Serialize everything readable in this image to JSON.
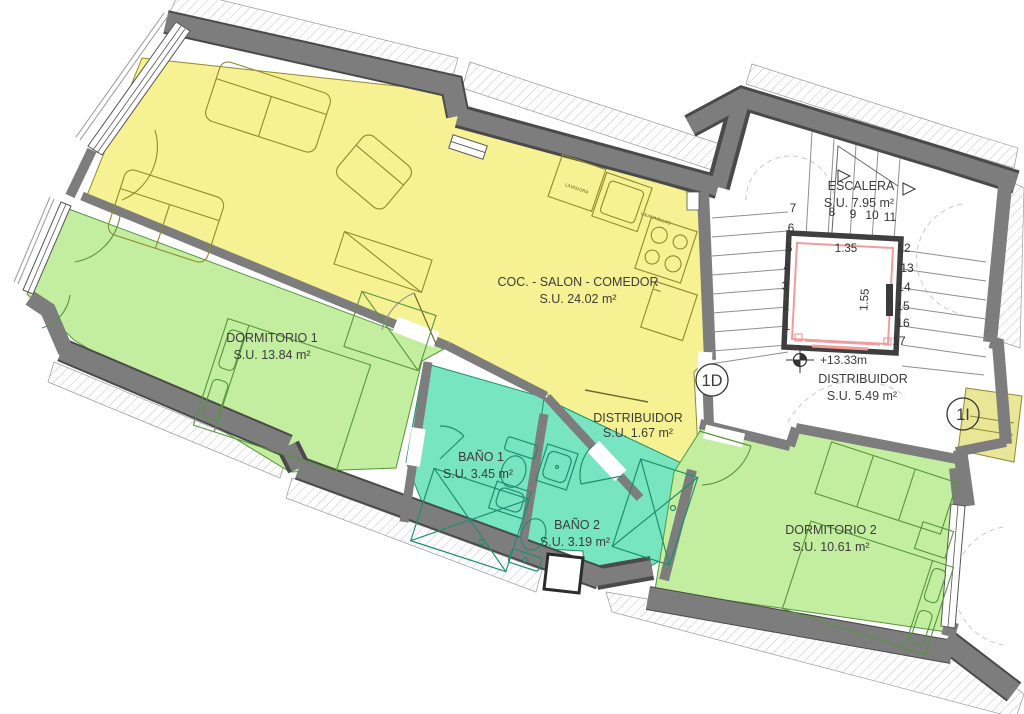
{
  "plan": {
    "type": "architectural-floor-plan",
    "colors": {
      "room_yellow": "#F6F293",
      "room_green": "#C3EE9F",
      "room_teal": "#77E5BF",
      "wall_gray": "#7D7D7D",
      "elevator_red": "#F29B9B",
      "text": "#3C3C3C"
    },
    "rooms": {
      "salon": {
        "label": "COC. - SALON - COMEDOR",
        "area": "S.U. 24.02 m²"
      },
      "dormitorio1": {
        "label": "DORMITORIO 1",
        "area": "S.U. 13.84 m²"
      },
      "bano1": {
        "label": "BAÑO 1",
        "area": "S.U. 3.45 m²"
      },
      "bano2": {
        "label": "BAÑO 2",
        "area": "S.U. 3.19 m²"
      },
      "distribuidor_vivienda": {
        "label": "DISTRIBUIDOR",
        "area": "S.U. 1.67 m²"
      },
      "distribuidor_rellano": {
        "label": "DISTRIBUIDOR",
        "area": "S.U. 5.49 m²"
      },
      "escalera": {
        "label": "ESCALERA",
        "area": "S.U. 7.95 m²"
      },
      "dormitorio2": {
        "label": "DORMITORIO 2",
        "area": "S.U. 10.61 m²"
      }
    },
    "markers": {
      "door_right_unit": "1D",
      "door_left_unit": "1I",
      "level": "+13.33m"
    },
    "elevator": {
      "width": "1.35",
      "depth": "1.55"
    },
    "appliances": {
      "washer": "LAVADORA",
      "dishwasher": "LAVAVAJILLAS"
    },
    "stairs": {
      "numbers": [
        "1",
        "2",
        "3",
        "4",
        "5",
        "6",
        "7",
        "8",
        "9",
        "10",
        "11",
        "12",
        "13",
        "14",
        "15",
        "16",
        "17"
      ]
    }
  }
}
